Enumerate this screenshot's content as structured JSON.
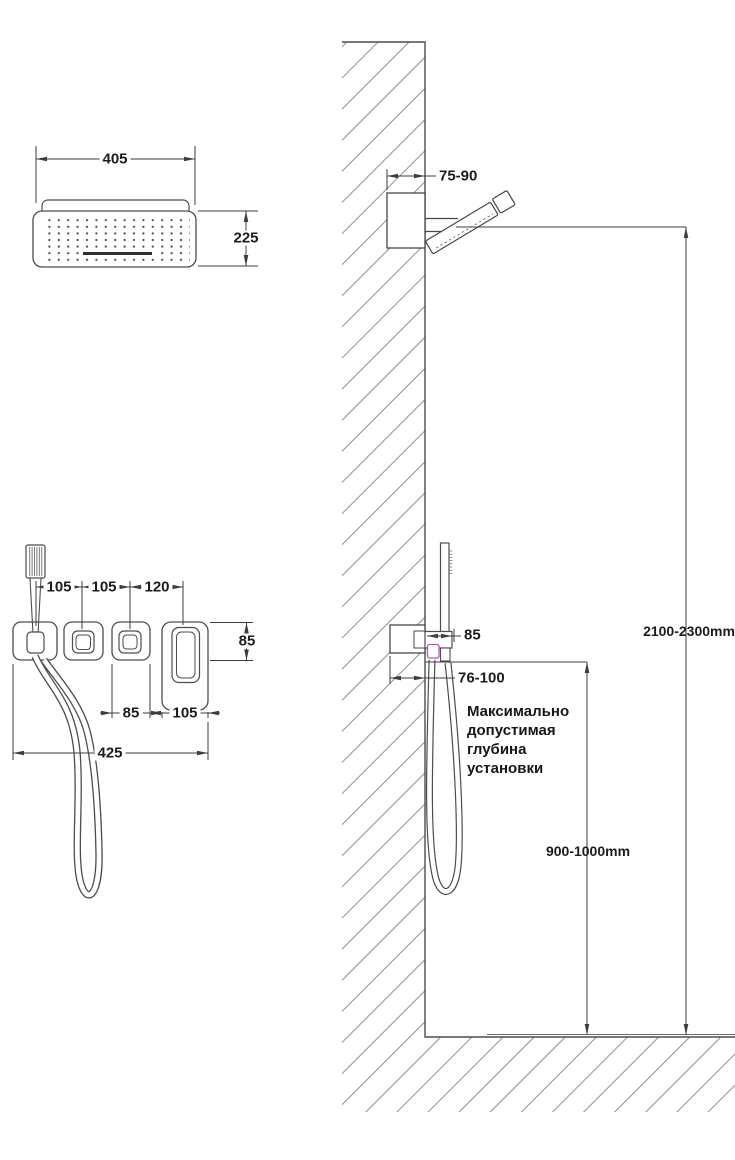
{
  "colors": {
    "line": "#3d3d3d",
    "hatch": "#8f8f8f",
    "magenta": "#b45ab4"
  },
  "head_front": {
    "width": "405",
    "depth": "225"
  },
  "trim_front": {
    "spacings": [
      "105",
      "105",
      "120"
    ],
    "plate_height": "85",
    "plate3_width": "85",
    "plate4_width": "105",
    "total_width": "425"
  },
  "side_view": {
    "head_embed_depth": "75-90",
    "head_height": "2100-2300mm",
    "holder_size": "85",
    "valve_embed_depth": "76-100",
    "valve_height": "900-1000mm",
    "note": "Максимально допустимая глубина установки"
  }
}
